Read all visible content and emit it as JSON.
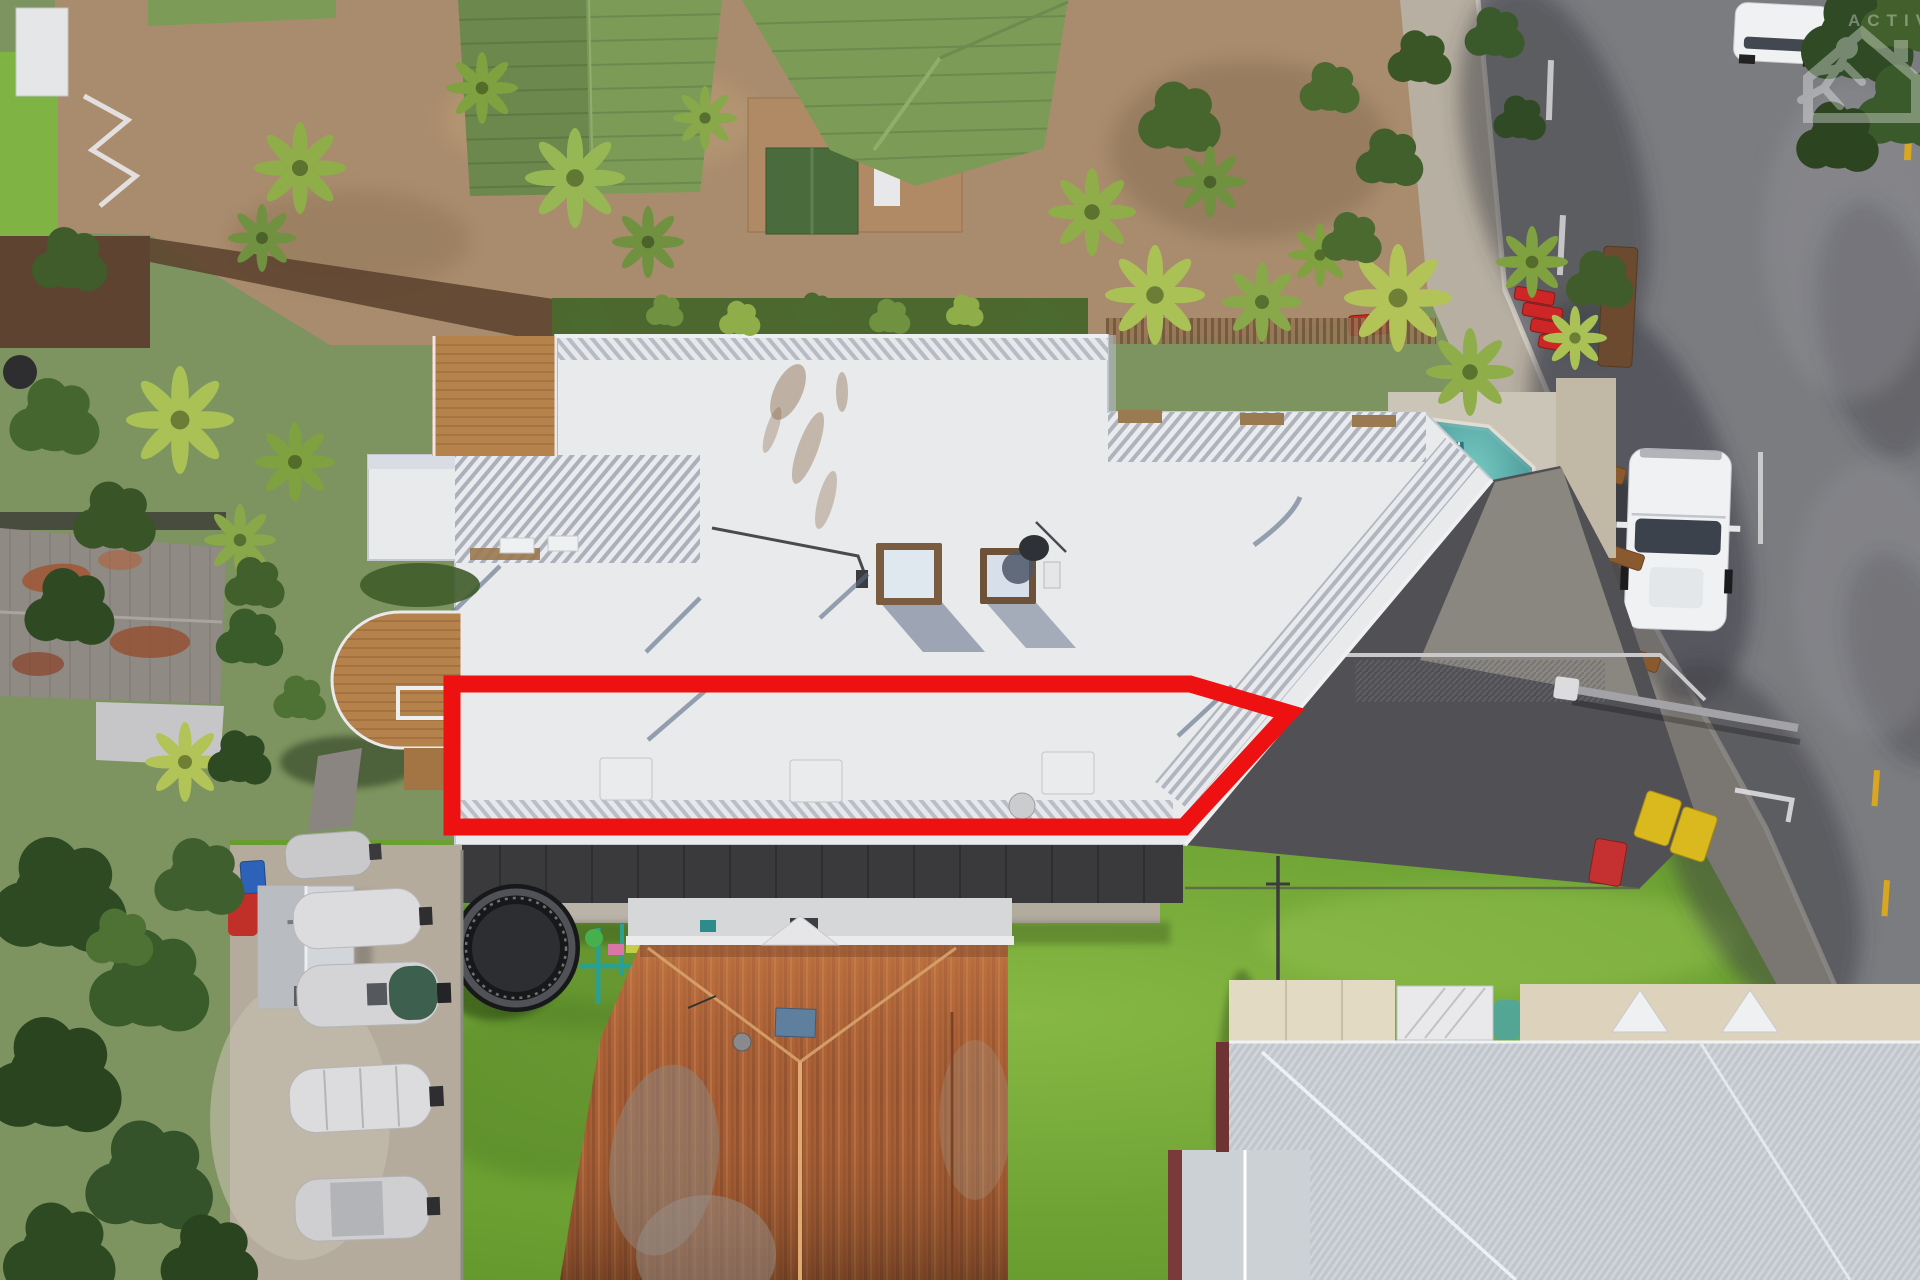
{
  "image": {
    "type": "aerial-drone-photograph",
    "description": "Top-down aerial photo of a residential block: a large white-roofed apartment building with a red outline highlighting one property section, swimming pool, street with parked van, lawns, boats, an old rusty-roof cottage and a modern metal-roof house",
    "width": 1920,
    "height": 1280
  },
  "watermark": {
    "text": "ACTIVE",
    "icon": "house-with-running-person-icon",
    "color": "#ffffff",
    "opacity": 0.34
  },
  "boundary": {
    "label": "highlighted property outline",
    "color": "#ee1111",
    "stroke_width": 17,
    "points": "452,684 1190,684 1289,713 1184,827 452,827"
  },
  "palette": {
    "lawn": "#74a636",
    "lawn_light": "#8cbb49",
    "tree_dark": "#2e4a22",
    "tree_mid": "#3f5f2c",
    "palm_light": "#a9c155",
    "brick_paving": "#a98c6d",
    "tile_roof_green": "#7c9b57",
    "white_roof": "#e9eaec",
    "roof_shadow": "#c7cad2",
    "pool_water": "#4ea6a4",
    "pool_deck": "#cbc5b8",
    "road_asphalt": "#7b7c80",
    "footpath": "#b7afa1",
    "driveway_dark": "#515155",
    "retaining_wall": "#3a3a3c",
    "rust_roof": "#a85f36",
    "silver_roof": "#c6cbd1",
    "cream_roof": "#e3dac4",
    "maroon_trim": "#6e3434",
    "timber_deck": "#b5824c",
    "shed_roof_grey": "#8f8a84",
    "gravel_yard": "#b4ab9c",
    "boat_cover": "#dcdcde",
    "van_white": "#f0f1f3",
    "bin_yellow": "#d9b91e",
    "bin_red": "#c53030",
    "bin_blue": "#2e62b8",
    "road_line_yellow": "#d9a621",
    "road_line_white": "#d8d8da"
  },
  "objects": [
    {
      "name": "apartment-building-white-roof",
      "label": "large white flat roof of apartment building"
    },
    {
      "name": "property-boundary-outline",
      "label": "red outline around lower unit of building"
    },
    {
      "name": "swimming-pool",
      "label": "teal pool with lap-lane"
    },
    {
      "name": "skylights",
      "count": 2
    },
    {
      "name": "satellite-dish",
      "count": 1
    },
    {
      "name": "pergola-louvres",
      "label": "slatted roof sections"
    },
    {
      "name": "curved-timber-deck",
      "label": "round-ended wooden deck on left"
    },
    {
      "name": "driveway-carport",
      "label": "dark carport roof and concrete ramp"
    },
    {
      "name": "wheelie-bins",
      "colors": [
        "yellow",
        "yellow",
        "red",
        "blue"
      ]
    },
    {
      "name": "street-road",
      "label": "asphalt road with tree shadows"
    },
    {
      "name": "footpath",
      "label": "concrete footpath along road"
    },
    {
      "name": "white-van",
      "label": "white van parked on street"
    },
    {
      "name": "white-car",
      "label": "white car at top of street"
    },
    {
      "name": "street-benches",
      "count": 4
    },
    {
      "name": "red-street-furniture",
      "count": 5
    },
    {
      "name": "backyard-lawn",
      "label": "large green lawn"
    },
    {
      "name": "trampoline",
      "count": 1
    },
    {
      "name": "kids-play-equipment",
      "count": 1
    },
    {
      "name": "rusty-corrugated-roof-house",
      "label": "old cottage with heavily rusted roof"
    },
    {
      "name": "modern-metal-roof-house",
      "label": "new house with silver and cream roof, maroon trim"
    },
    {
      "name": "boats-on-trailers",
      "count": 5
    },
    {
      "name": "garden-shed",
      "count": 1
    },
    {
      "name": "green-tiled-unit-roofs",
      "count": 2
    },
    {
      "name": "brick-courtyard",
      "label": "brown brick paved courtyard"
    },
    {
      "name": "old-shed-rusty-roof",
      "label": "grey shed roof with rust patches on left"
    },
    {
      "name": "palm-trees",
      "label": "many tropical palms and dense trees"
    }
  ]
}
